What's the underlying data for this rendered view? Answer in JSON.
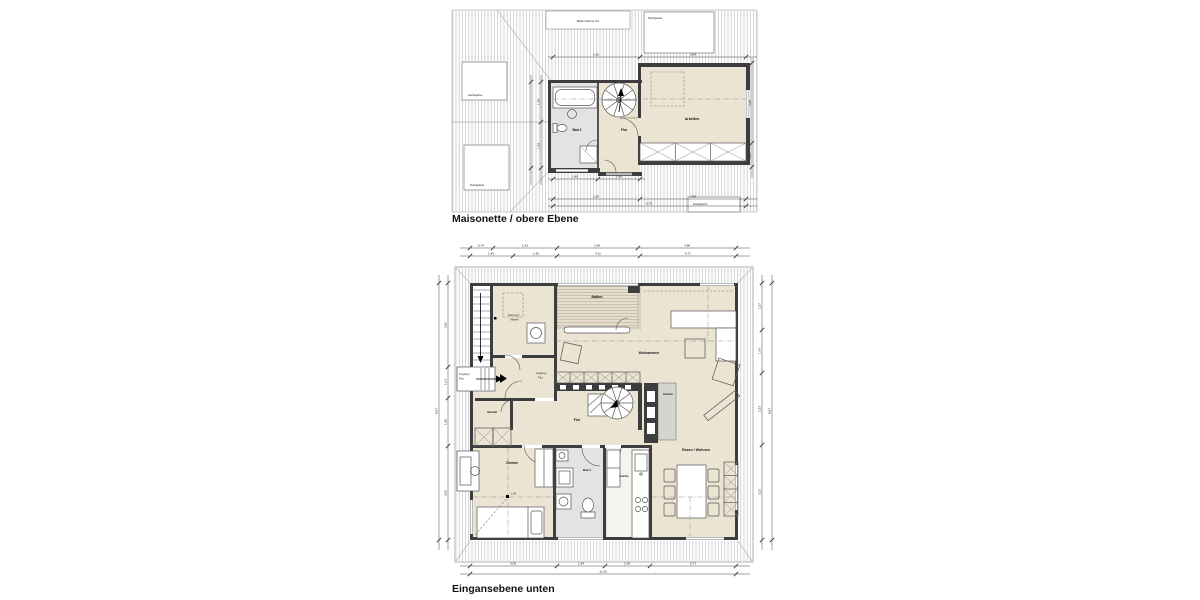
{
  "sheet": {
    "background": "#ffffff"
  },
  "colors": {
    "wall": "#3d3d3d",
    "room_fill": "#ece4d2",
    "bath_fill": "#e3e3e1",
    "roof_hatch": "#bdbdbd",
    "dim_line": "#444444"
  },
  "upper": {
    "title": "Maisonette / obere Ebene",
    "labels": {
      "balkon_ug": "Balkon Ebene UG",
      "dachgaube": "Dachgaube",
      "bad": "Bad 2",
      "flur": "Flur",
      "arbeiten": "Arbeiten"
    },
    "dims": {
      "top": [
        "2,93",
        "3,54"
      ],
      "right": [
        "2,65",
        "0,83"
      ],
      "mid": [
        "1,33",
        "1,53"
      ],
      "inner_bottom": [
        "1,49",
        "1,40"
      ],
      "bottom": [
        "2,90",
        "3,89"
      ],
      "total": "6,79"
    }
  },
  "lower": {
    "title": "Eingansebene unten",
    "labels": {
      "heizung_1": "Heizung /",
      "heizung_2": "Abstell",
      "zugang_1": "Zugang /",
      "zugang_2": "Flur",
      "abstell": "Abstell",
      "balkon": "Balkon",
      "wohnzimmer": "Wohnzimmer",
      "kamin": "Kamin",
      "flur": "Flur",
      "zimmer": "Zimmer",
      "bad": "Bad 1",
      "kueche": "Küche",
      "essen": "Essen / Wohnen",
      "height_marker": "1,50"
    },
    "dims": {
      "top1": [
        "0,74",
        "1,43",
        "3,48",
        "4,98"
      ],
      "top2": [
        "1,43",
        "1,92",
        "4,11",
        "5,71"
      ],
      "bottom1": [
        "3,06",
        "1,54",
        "2,36",
        "5,71"
      ],
      "bottom_total": "11,30",
      "left1": [
        "2,80",
        "1,04",
        "1,66",
        "3,06"
      ],
      "left_total": "8,57",
      "right1": [
        "1,57",
        "1,43",
        "2,33",
        "3,23"
      ],
      "right_total": "8,57"
    }
  }
}
